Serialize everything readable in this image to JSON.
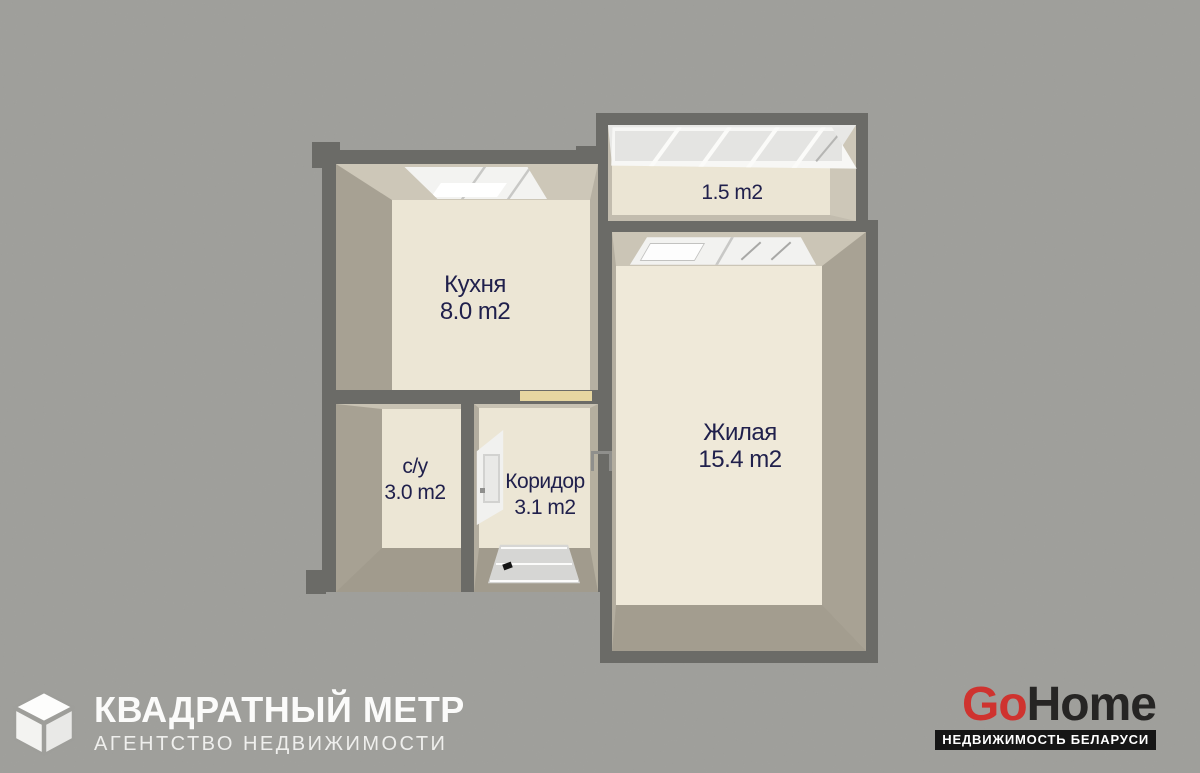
{
  "floorplan": {
    "label_color": "#20204c",
    "rooms": [
      {
        "key": "kitchen",
        "name": "Кухня",
        "area": "8.0 m2"
      },
      {
        "key": "living",
        "name": "Жилая",
        "area": "15.4 m2"
      },
      {
        "key": "balcony",
        "name": "",
        "area": "1.5 m2"
      },
      {
        "key": "bathroom",
        "name": "с/у",
        "area": "3.0 m2"
      },
      {
        "key": "corridor",
        "name": "Коридор",
        "area": "3.1 m2"
      }
    ],
    "colors": {
      "background": "#9e9e9a",
      "wall": "#6b6b67",
      "wall_face_light": "#cdc7b8",
      "wall_face_dark": "#a7a193",
      "floor": "#ece6d5",
      "threshold": "#e6d6a1"
    }
  },
  "branding": {
    "agency": {
      "title": "КВАДРАТНЫЙ МЕТР",
      "subtitle": "АГЕНТСТВО НЕДВИЖИМОСТИ",
      "icon": "cube-icon",
      "text_color": "#fbfbfa"
    },
    "portal": {
      "brand_go": "Go",
      "brand_home": "Home",
      "tagline": "НЕДВИЖИМОСТЬ БЕЛАРУСИ",
      "accent_color": "#cf332f",
      "dark_color": "#262524",
      "bar_color": "#161616"
    }
  }
}
